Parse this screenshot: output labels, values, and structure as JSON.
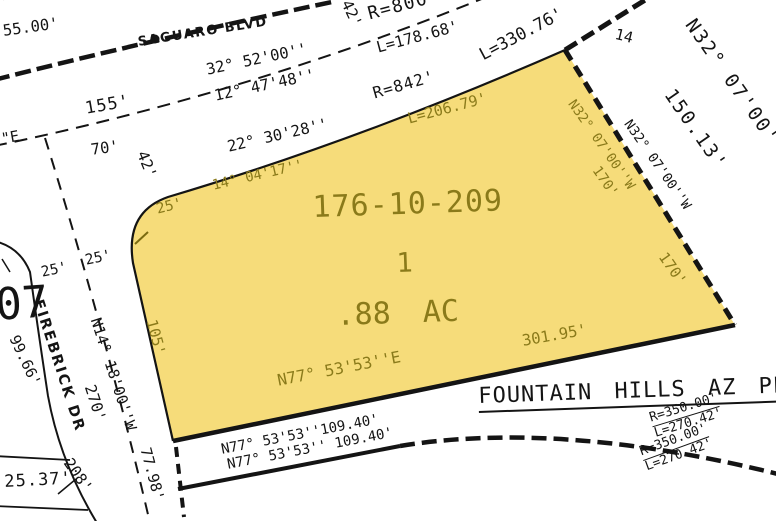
{
  "map": {
    "colors": {
      "parcel_fill": "#F6DC7A",
      "parcel_label": "#8A7A1A",
      "line": "#141414",
      "background": "#FFFFFF"
    },
    "parcel": {
      "apn": "176-10-209",
      "lot": "1",
      "area_acres": ".88 AC"
    },
    "streets": {
      "saguaro": "SAGUARO BLVD",
      "firebrick": "FIREBRICK DR"
    },
    "plat_title": "FOUNTAIN HILLS AZ PLA",
    "labels": {
      "cut_top_bearing": "42'00''",
      "dim_55": "55.00'",
      "dim_155": "155'",
      "angle_32_52": "32° 52'00''",
      "angle_12_47": "12° 47'48''",
      "dim_70": "70'",
      "dim_42_left": "42'",
      "dim_42_top": "42'",
      "r800": "R=800'",
      "l178": "L=178.68'",
      "l330": "L=330.76'",
      "r842": "R=842'",
      "l206": "L=206.79'",
      "angle_22_30": "22° 30'28''",
      "angle_14_04": "14° 04'17''",
      "dim_25_parcel": "25'",
      "dim_105": "105'",
      "bearing_n77_parcel": "N77° 53'53''E",
      "dim_301": "301.95'",
      "bearing_n32_parcel": "N32° 07'00''W",
      "dim_170_upper": "170'",
      "dim_170": "170'",
      "bearing_n32_edge": "N32° 07'00''W",
      "bearing_n32_big": "N32° 07'00''W",
      "dim_150": "150.13'",
      "lot_14": "14",
      "bearing_n14": "N14° 18'00''W",
      "dim_270": "270'",
      "dim_99": "99.66'",
      "num_07": "07",
      "dim_25_left": "25'",
      "dim_25_right": "25'",
      "dim_208": "208'",
      "dim_77": "77.98'",
      "dim_25_37": "25.37'",
      "bearing_e_cut": "\"E",
      "bearing_n77_a": "N77° 53'53''109.40'",
      "bearing_n77_b": "N77° 53'53'' 109.40'",
      "r350_a": "R=350.00'",
      "l270_a": "L=270.42'",
      "r350_b": "R=350.00'",
      "l270_b": "L=270.42'"
    }
  }
}
